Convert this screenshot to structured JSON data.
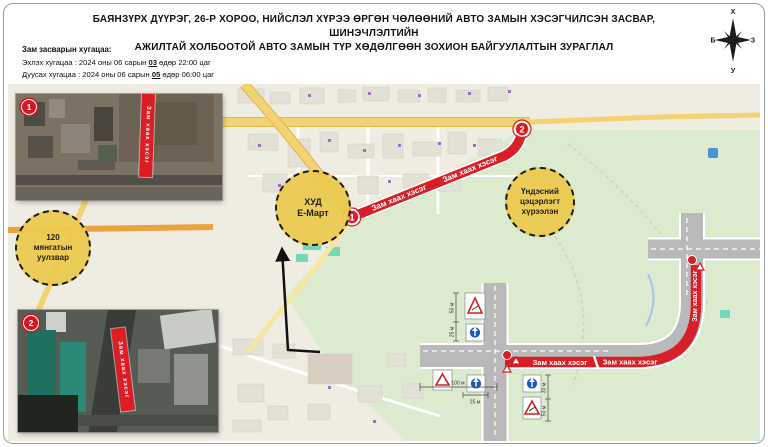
{
  "title": {
    "line1": "БАЯНЗҮРХ ДҮҮРЭГ, 26-Р ХОРОО, НИЙСЛЭЛ ХҮРЭЭ ӨРГӨН ЧӨЛӨӨНИЙ АВТО ЗАМЫН ХЭСЭГЧИЛСЭН ЗАСВАР, ШИНЭЧЛЭЛТИЙН",
    "line2": "АЖИЛТАЙ ХОЛБООТОЙ АВТО ЗАМЫН ТҮР ХӨДӨЛГӨӨН ЗОХИОН БАЙГУУЛАЛТЫН ЗУРАГЛАЛ"
  },
  "schedule": {
    "heading": "Зам засварын хугацаа:",
    "start_prefix": "Эхлэх хугацаа : 2024 оны 06 сарын ",
    "start_day": "03",
    "start_suffix": " өдөр 22:00 цаг",
    "end_prefix": "Дуусах хугацаа : 2024 оны 06 сарын ",
    "end_day": "05",
    "end_suffix": " өдөр 06:00 цаг"
  },
  "compass": {
    "north": "Х",
    "south": "У",
    "east": "З",
    "west": "Б"
  },
  "labels": {
    "closure": "Зам хаах хэсэг"
  },
  "markers": {
    "m1": "1",
    "m2": "2"
  },
  "zones": {
    "zone1": {
      "line1": "120",
      "line2": "мянгатын",
      "line3": "уулзвар"
    },
    "zone2": {
      "line1": "ХУД",
      "line2": "Е-Март"
    },
    "zone3": {
      "line1": "Үндэсний",
      "line2": "цэцэрлэгт",
      "line3": "хүрээлэн"
    }
  },
  "diagram": {
    "dims": {
      "d50": "50 м",
      "d25": "25 м",
      "d100": "100 м",
      "d30": "30 м"
    }
  },
  "colors": {
    "closure_red": "#d81e26",
    "zone_yellow": "#ecc94e",
    "road_yellow": "#f2d271",
    "park_green": "#dcead0",
    "diagram_road_gray": "#b9b9b9"
  }
}
